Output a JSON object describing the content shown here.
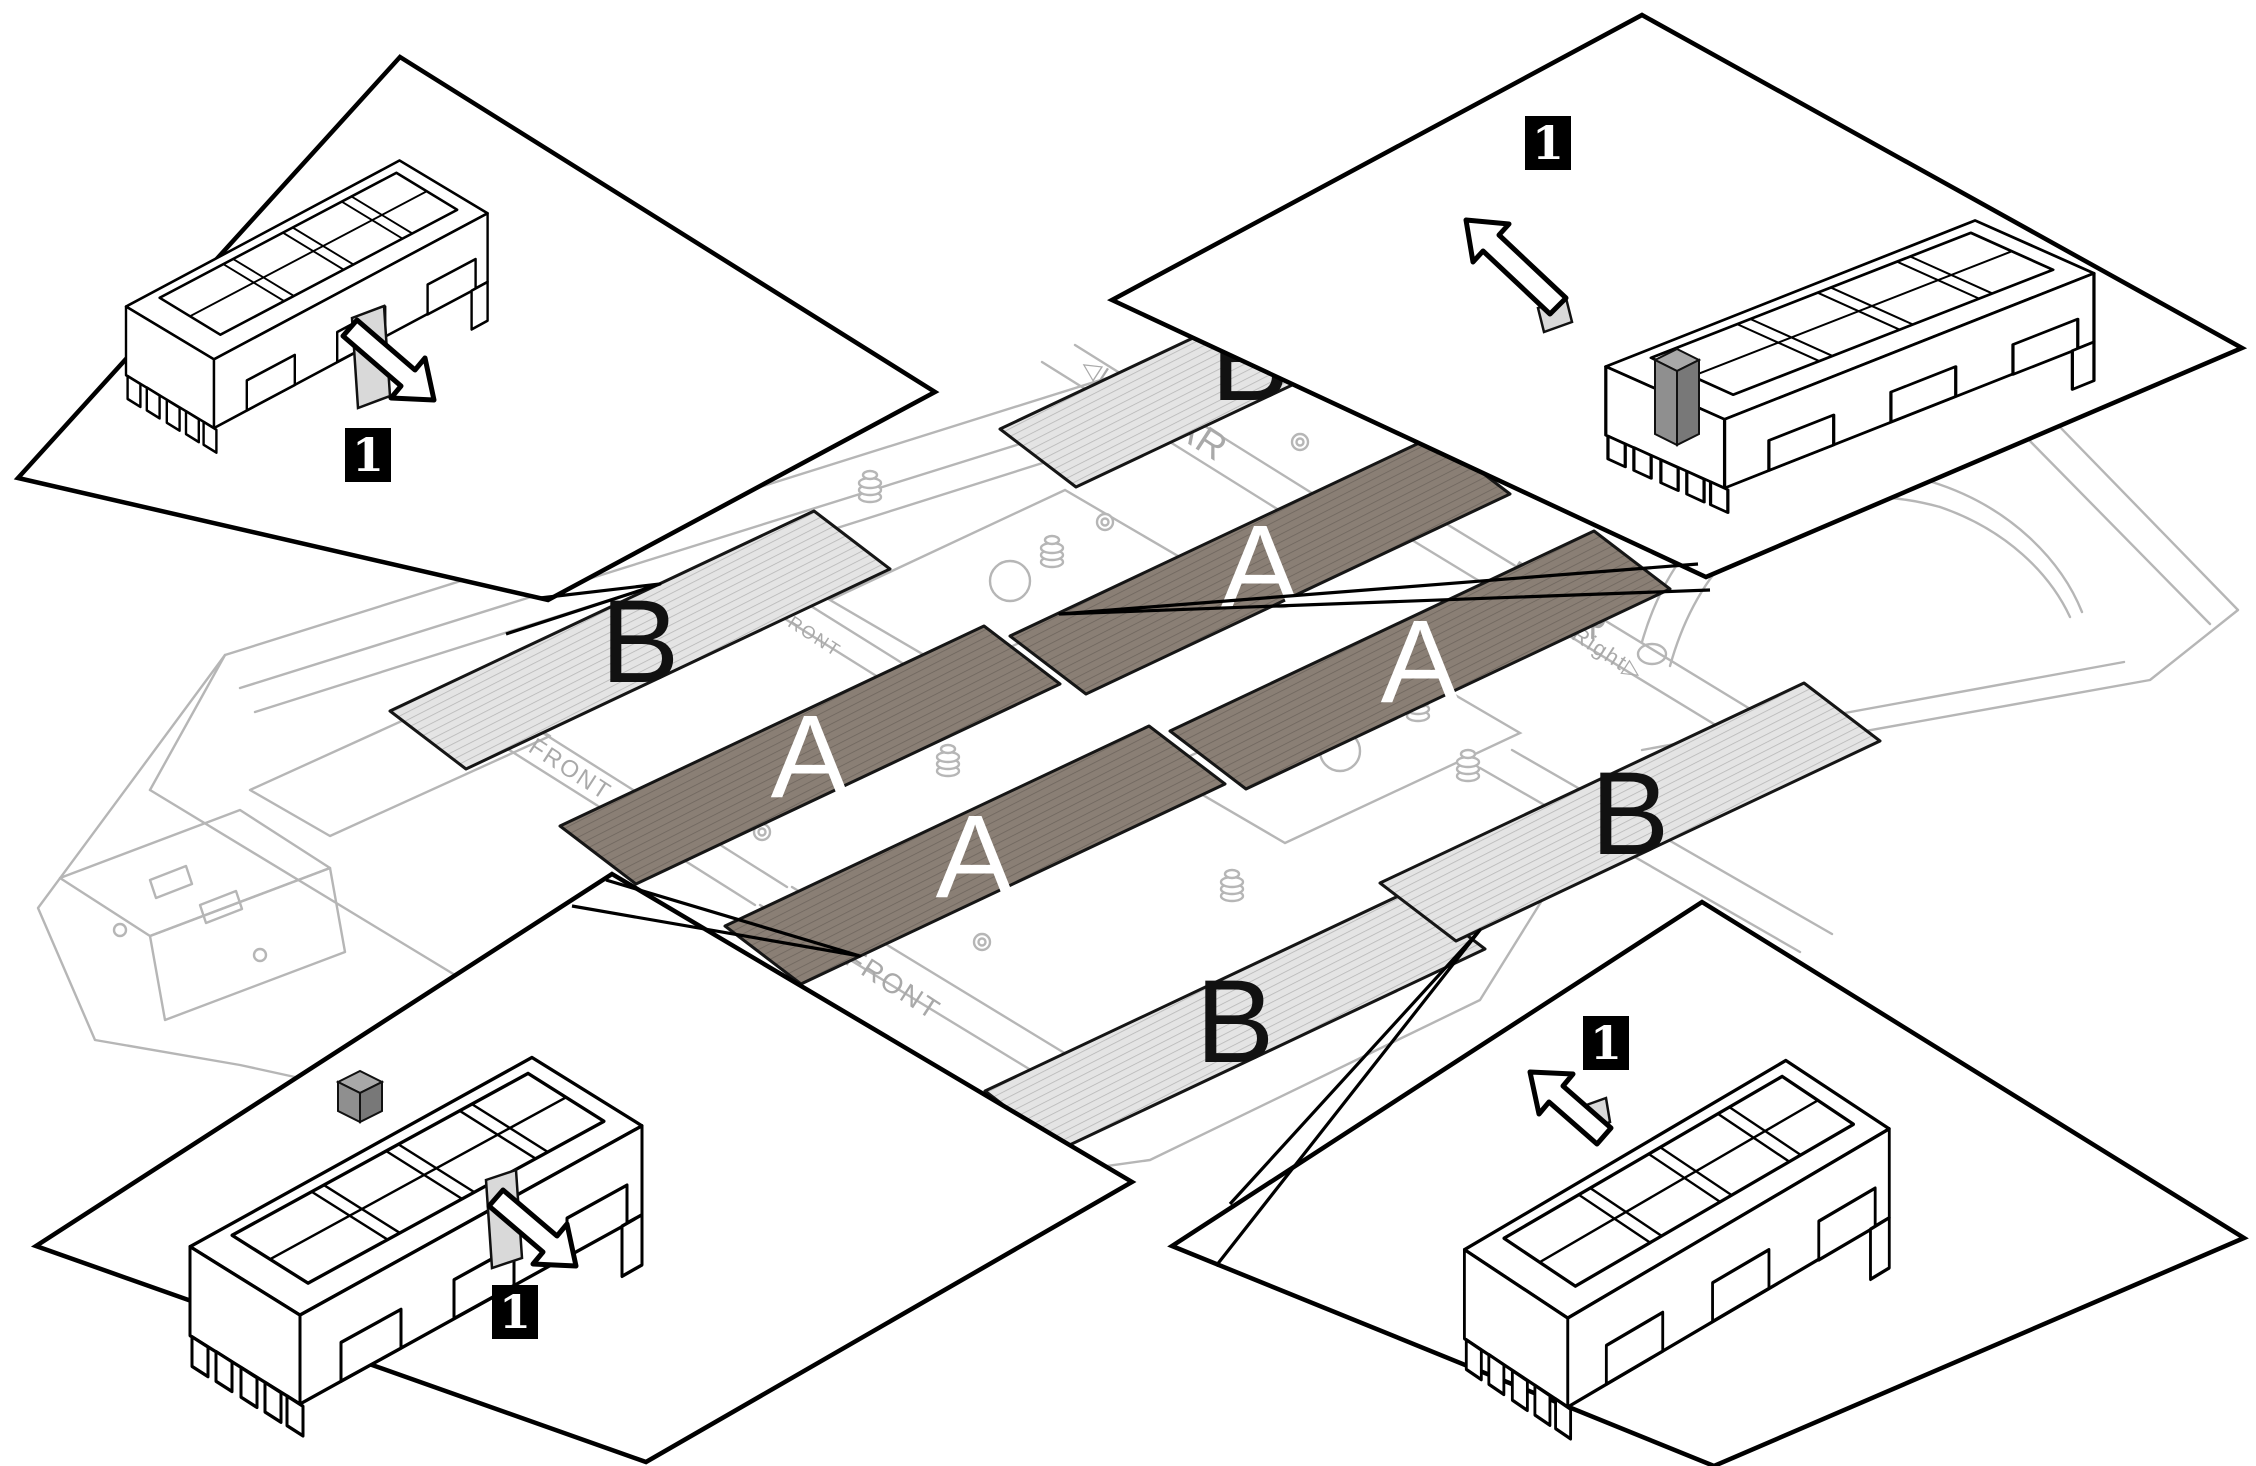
{
  "diagram": {
    "regions": {
      "a": {
        "label": "A",
        "fill": "#8a7f75",
        "label_color": "#ffffff"
      },
      "b": {
        "label": "B",
        "fill": "#e4e4e4",
        "label_color": "#111111"
      }
    },
    "insets": [
      {
        "position": "top-left",
        "callout": "1"
      },
      {
        "position": "top-right",
        "callout": "1"
      },
      {
        "position": "bottom-left",
        "callout": "1"
      },
      {
        "position": "bottom-right",
        "callout": "1"
      }
    ],
    "callout_style": {
      "bg": "#000000",
      "fg": "#ffffff"
    },
    "chassis_labels": {
      "left": "◁Left",
      "rear_left": "REAR",
      "rear_right": "REAR",
      "right": "Right▷",
      "front_upper": "FRONT",
      "front_left": "FRONT",
      "front_lower": "FRONT"
    },
    "palette": {
      "line_art": "#b6b6b6",
      "outline": "#000000",
      "tab_fill": "#d9d9d9",
      "block_fill": "#8f8f8f"
    }
  }
}
